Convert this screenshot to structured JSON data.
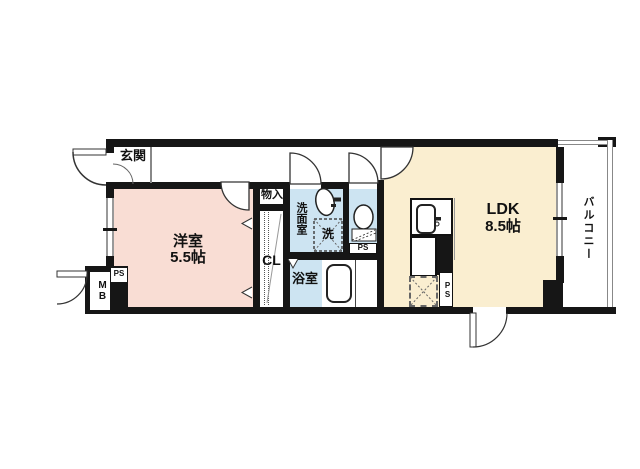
{
  "rooms": {
    "genkan": {
      "label": "玄関"
    },
    "western_room": {
      "label": "洋室",
      "size": "5.5帖"
    },
    "storage": {
      "label": "物入"
    },
    "closet": {
      "label": "CL"
    },
    "washroom": {
      "label": "洗面室"
    },
    "laundry": {
      "label": "洗"
    },
    "bathroom": {
      "label": "浴室"
    },
    "ldk": {
      "label": "LDK",
      "size": "8.5帖"
    },
    "balcony": {
      "label": "バルコニー"
    }
  },
  "utility": {
    "meter_box": "MB",
    "ps_entrance": "PS",
    "ps_toilet": "PS",
    "ps_kitchen": "PS"
  },
  "colors": {
    "wall": "#161616",
    "western_room_fill": "#F9DDD4",
    "ldk_fill": "#FAEED0",
    "wet_area_fill": "#CDE4F2",
    "background": "#FFFFFF"
  }
}
